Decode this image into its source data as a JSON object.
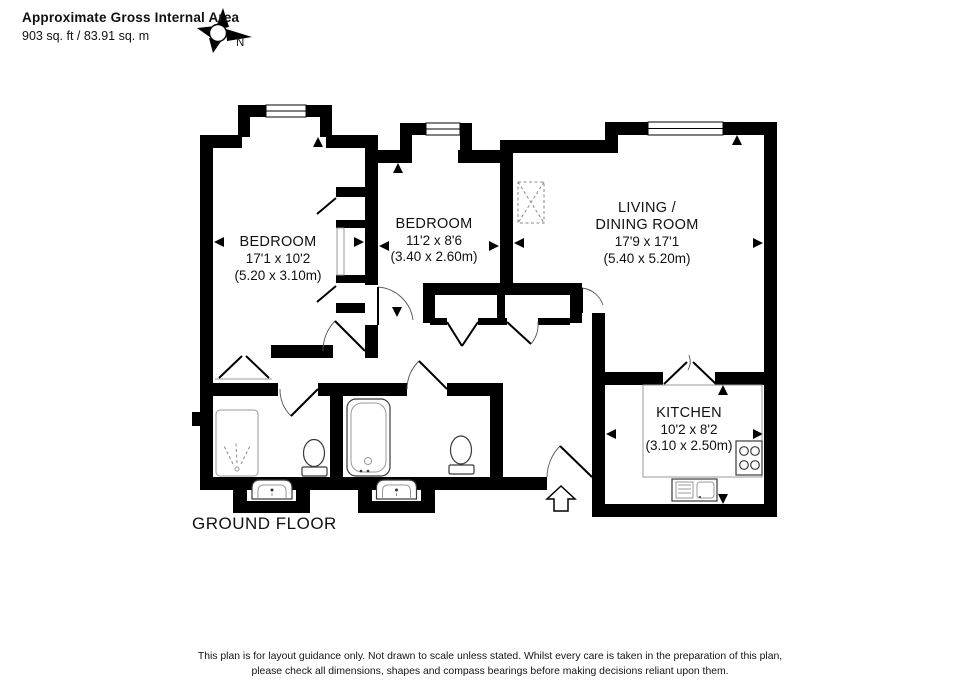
{
  "header": {
    "title": "Approximate Gross Internal Area",
    "area_label": "903 sq. ft / 83.91 sq. m"
  },
  "compass": {
    "label": "N",
    "icon": "compass-rose-icon"
  },
  "floor": {
    "label": "GROUND FLOOR"
  },
  "rooms": [
    {
      "id": "bedroom-1",
      "name": "BEDROOM",
      "imperial": "17'1 x 10'2",
      "metric": "(5.20 x 3.10m)"
    },
    {
      "id": "bedroom-2",
      "name": "BEDROOM",
      "imperial": "11'2 x 8'6",
      "metric": "(3.40 x 2.60m)"
    },
    {
      "id": "living-dining-room",
      "name_line1": "LIVING /",
      "name_line2": "DINING ROOM",
      "imperial": "17'9 x 17'1",
      "metric": "(5.40 x 5.20m)"
    },
    {
      "id": "kitchen",
      "name": "KITCHEN",
      "imperial": "10'2 x 8'2",
      "metric": "(3.10 x 2.50m)"
    }
  ],
  "fixtures": [
    "shower",
    "toilet",
    "wash-basin",
    "bath",
    "kitchen-sink",
    "hob",
    "wardrobe",
    "hall-cupboards",
    "entrance-arrow"
  ],
  "windows": [
    "bedroom-1-bay-window",
    "bedroom-2-bay-window",
    "living-room-window"
  ],
  "footer": {
    "line1": "This plan is for layout guidance only.  Not drawn to scale unless stated. Whilst every care is taken in the preparation of this plan,",
    "line2": "please check all dimensions, shapes and compass bearings before making decisions reliant upon them."
  },
  "colors": {
    "walls": "#000000",
    "background": "#ffffff",
    "text": "#111111",
    "fixture_stroke": "#3a3a3a",
    "faint_stroke": "#999999"
  }
}
